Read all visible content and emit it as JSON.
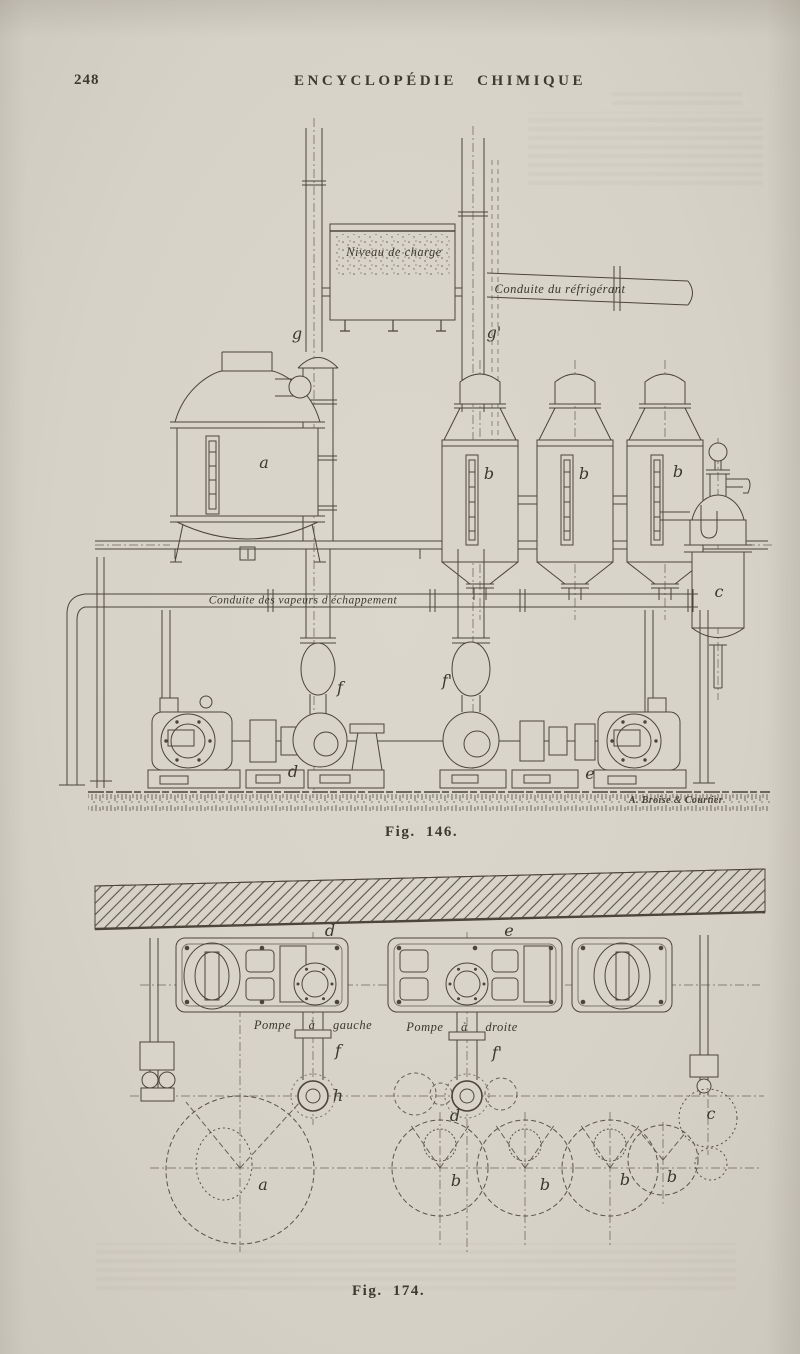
{
  "page": {
    "number": "248",
    "header": "ENCYCLOPÉDIE CHIMIQUE"
  },
  "colors": {
    "paper": "#d8d4ca",
    "ink": "#3e3a31",
    "line": "#4b453a"
  },
  "fig146": {
    "caption": "Fig. 146.",
    "signature": "A. Broise & Courtier",
    "labels": {
      "niveau_de_charge": "Niveau de charge",
      "conduite_refrigerant": "Conduite du réfrigérant",
      "conduite_vapeurs": "Conduite des vapeurs d'échappement",
      "g": "g",
      "g_prime": "g'",
      "a": "a",
      "b": "b",
      "c": "c",
      "f": "f",
      "f_prime": "f'",
      "d": "d",
      "e": "e"
    }
  },
  "fig174": {
    "caption": "Fig. 174.",
    "labels": {
      "d": "d",
      "e": "e",
      "pompe_gauche": "Pompe à gauche",
      "pompe_droite": "Pompe à droite",
      "f": "f",
      "f_prime": "f'",
      "h": "h",
      "a": "a",
      "b": "b",
      "c": "c"
    }
  }
}
